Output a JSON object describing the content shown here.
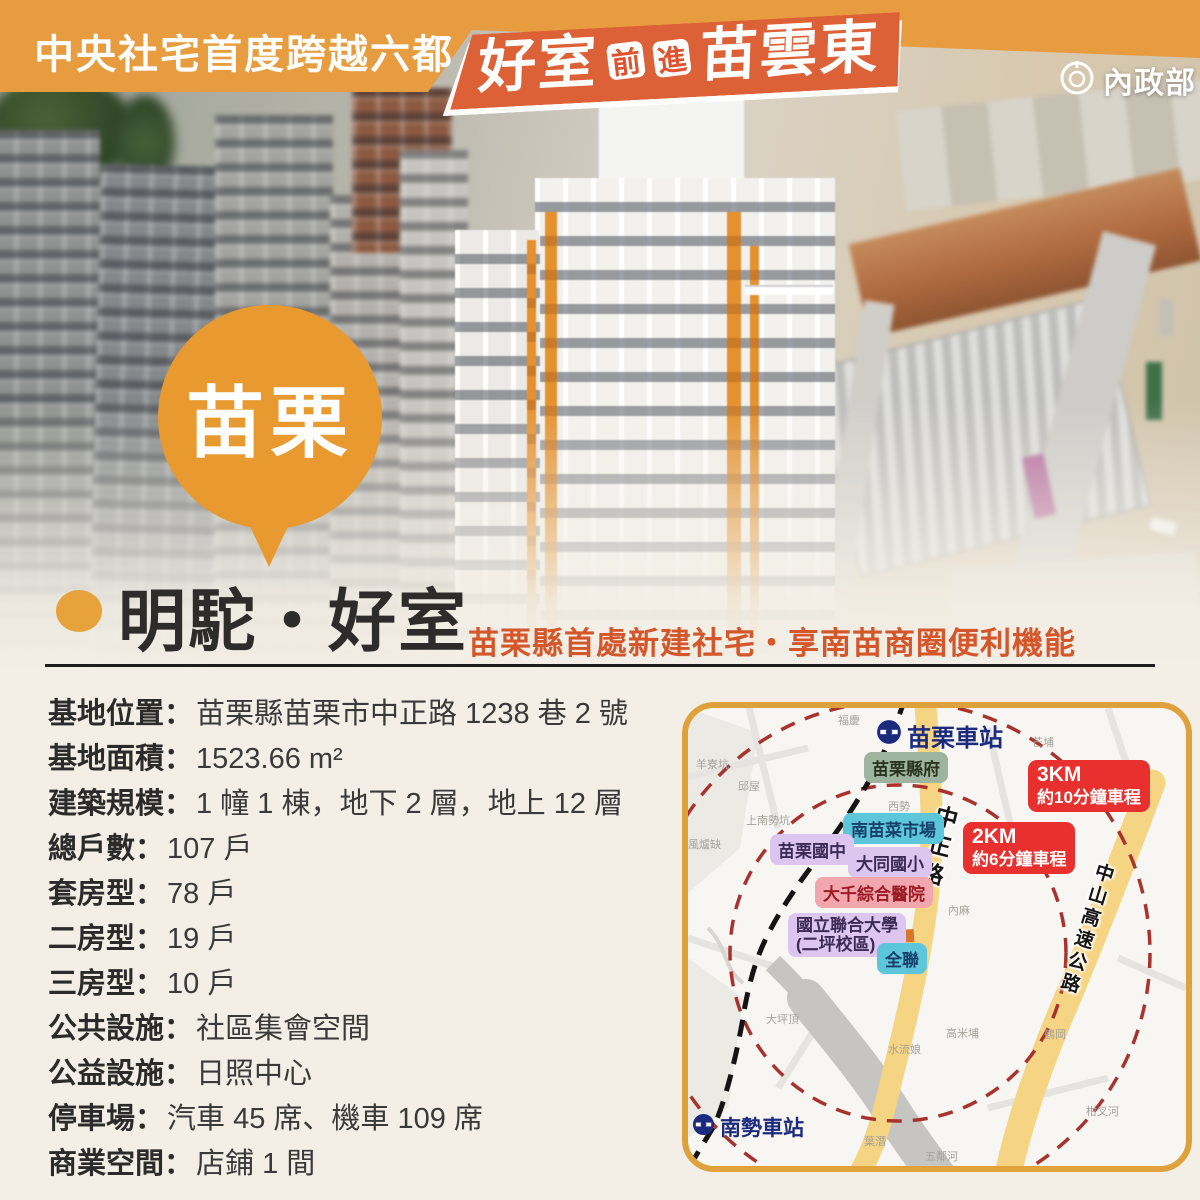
{
  "header": {
    "left_banner": "中央社宅首度跨越六都",
    "main_title_part1": "好室",
    "main_title_mid1": "前",
    "main_title_mid2": "進",
    "main_title_part2": "苗雲東",
    "logo": "內政部"
  },
  "city_badge": "苗栗",
  "project": {
    "title": "明駝・好室",
    "subtitle": "苗栗縣首處新建社宅・享南苗商圈便利機能"
  },
  "details": [
    {
      "label": "基地位置：",
      "value": "苗栗縣苗栗市中正路 1238 巷 2 號"
    },
    {
      "label": "基地面積：",
      "value": "1523.66 m²"
    },
    {
      "label": "建築規模：",
      "value": "1 幢 1 棟，地下 2 層，地上 12 層"
    },
    {
      "label": "總戶數：",
      "value": "107 戶"
    },
    {
      "label": "套房型：",
      "value": "78 戶"
    },
    {
      "label": "二房型：",
      "value": "19 戶"
    },
    {
      "label": "三房型：",
      "value": "10 戶"
    },
    {
      "label": "公共設施：",
      "value": "社區集會空間"
    },
    {
      "label": "公益設施：",
      "value": "日照中心"
    },
    {
      "label": "停車場：",
      "value": "汽車 45 席、機車 109 席"
    },
    {
      "label": "商業空間：",
      "value": "店鋪 1 間"
    }
  ],
  "map": {
    "stations": [
      {
        "name": "苗栗車站"
      },
      {
        "name": "南勢車站"
      }
    ],
    "pois": [
      {
        "name": "苗栗縣府"
      },
      {
        "name": "南苗菜市場"
      },
      {
        "name": "苗栗國中"
      },
      {
        "name": "大同國小"
      },
      {
        "name": "大千綜合醫院"
      },
      {
        "name": "國立聯合大學",
        "name2": "(二坪校區)"
      },
      {
        "name": "全聯"
      }
    ],
    "roads": [
      {
        "name": "中正路"
      },
      {
        "name": "中山高速公路"
      }
    ],
    "distance_badges": [
      {
        "distance": "3KM",
        "time": "約10分鐘車程"
      },
      {
        "distance": "2KM",
        "time": "約6分鐘車程"
      }
    ],
    "minor_labels": [
      "羊寮坑",
      "邱屋",
      "福慶",
      "芒埔",
      "西勢",
      "上南勢坑",
      "風爐缺",
      "內麻",
      "大坪頂",
      "水流娘",
      "高米埔",
      "鶴岡",
      "柑叉河",
      "葉潛",
      "五鄰河"
    ]
  },
  "colors": {
    "banner_orange": "#E89C40",
    "banner_red": "#DD6136",
    "subtitle_red": "#D4572B",
    "badge_orange": "#E8992F",
    "distance_badge_red": "#E8312E",
    "radius_circle_red": "#A8332E",
    "map_border_gold": "#DFA13C",
    "road_yellow": "#F5D484",
    "station_navy": "#1D2B7E"
  }
}
